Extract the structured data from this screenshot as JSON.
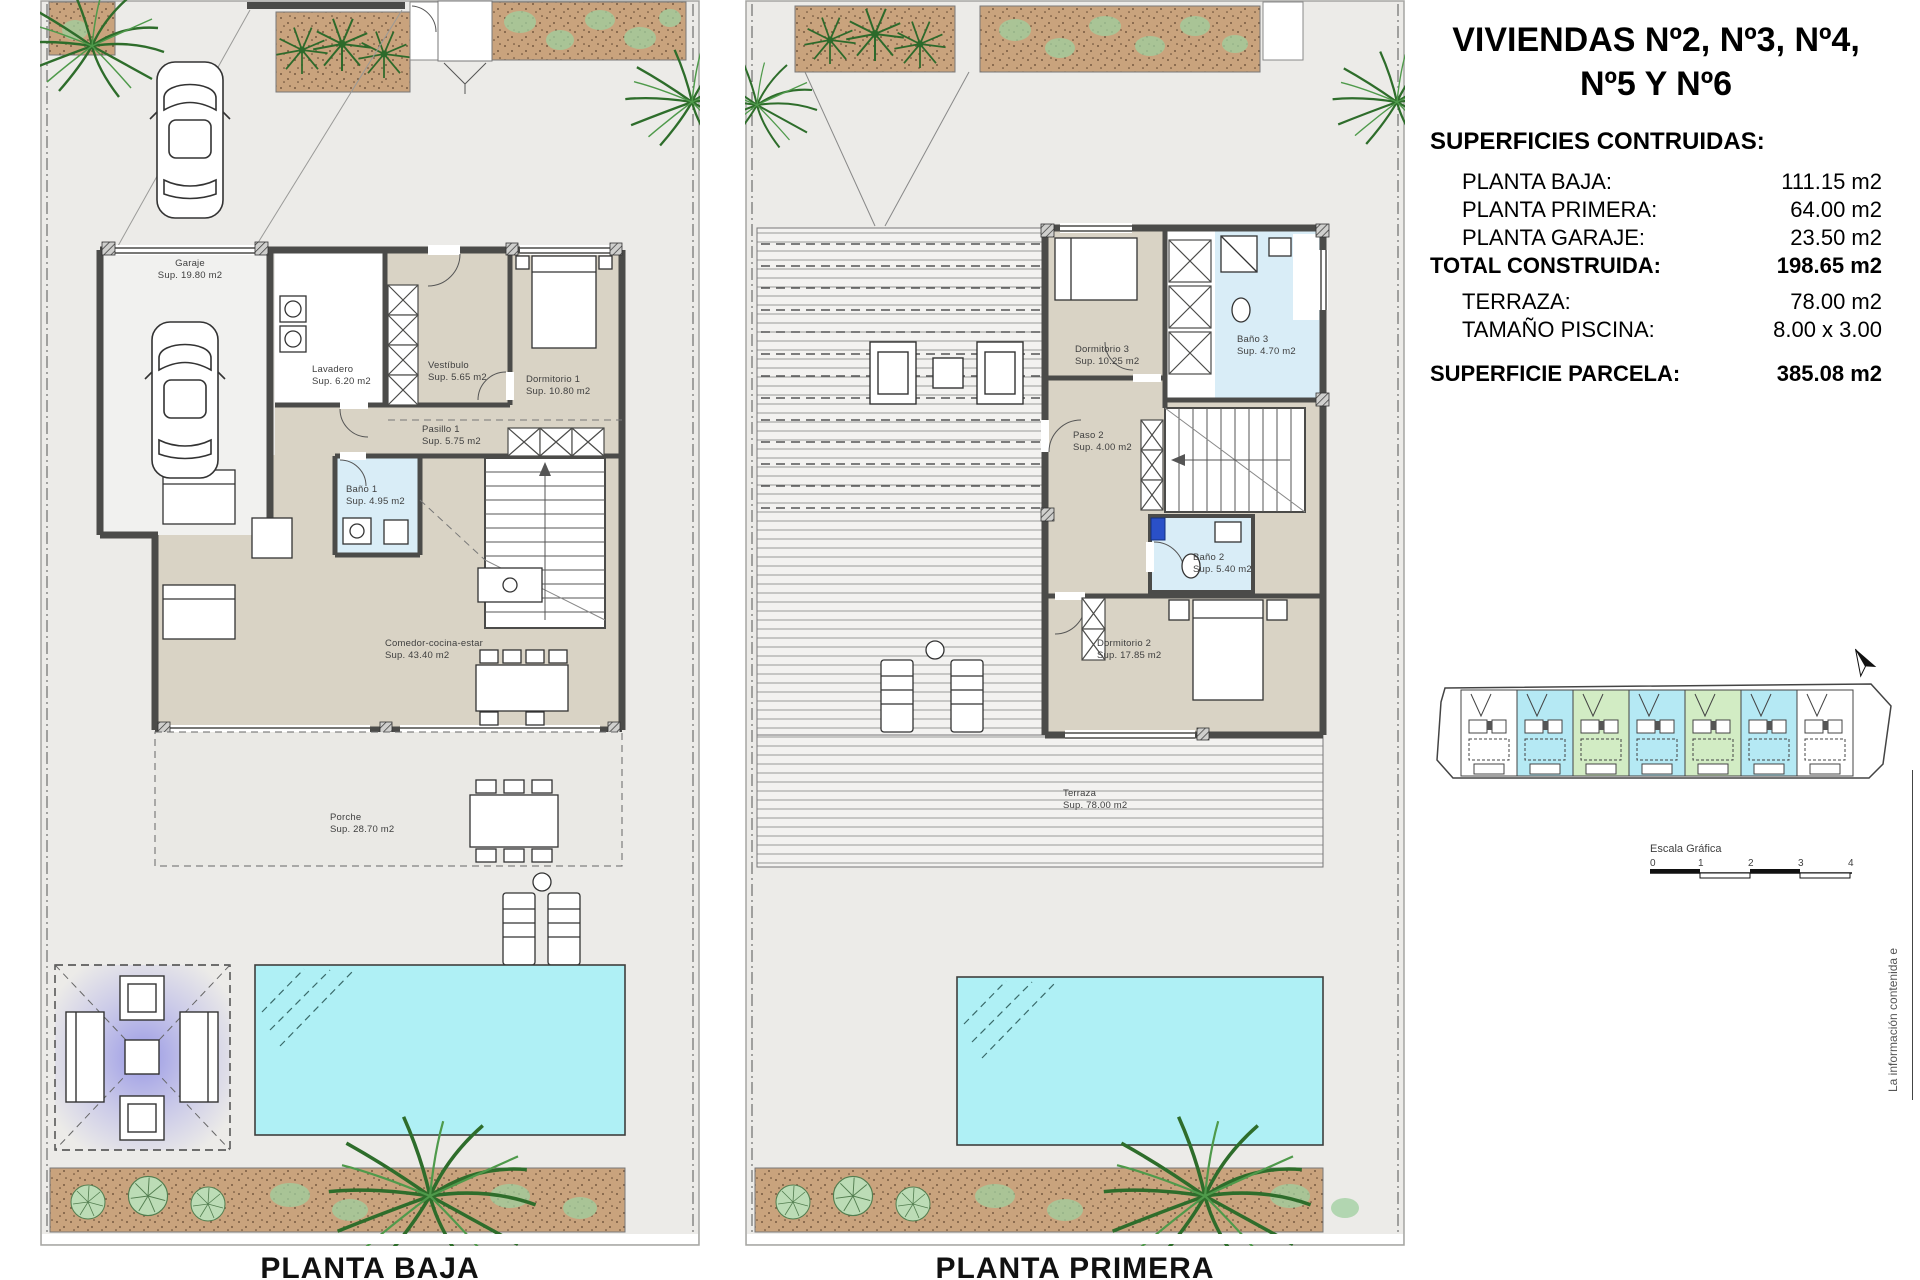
{
  "panel": {
    "title_line1": "VIVIENDAS Nº2, Nº3, Nº4,",
    "title_line2": "Nº5 Y Nº6",
    "superficies_heading": "SUPERFICIES CONTRUIDAS:",
    "rows": [
      {
        "label": "PLANTA BAJA:",
        "value": "111.15 m2"
      },
      {
        "label": "PLANTA PRIMERA:",
        "value": "64.00 m2"
      },
      {
        "label": "PLANTA GARAJE:",
        "value": "23.50 m2"
      },
      {
        "label": "TOTAL CONSTRUIDA:",
        "value": "198.65 m2"
      },
      {
        "label": "TERRAZA:",
        "value": "78.00 m2"
      },
      {
        "label": "TAMAÑO PISCINA:",
        "value": "8.00 x 3.00"
      },
      {
        "label": "SUPERFICIE PARCELA:",
        "value": "385.08 m2"
      }
    ],
    "scale_label": "Escala Gráfica",
    "scale_ticks": [
      "0",
      "1",
      "2",
      "3",
      "4"
    ],
    "side_note": "La información contenida e"
  },
  "plans": {
    "left": {
      "caption": "PLANTA BAJA",
      "rooms": [
        {
          "name": "Garaje",
          "area": "Sup. 19.80 m2"
        },
        {
          "name": "Lavadero",
          "area": "Sup. 6.20 m2"
        },
        {
          "name": "Vestíbulo",
          "area": "Sup. 5.65 m2"
        },
        {
          "name": "Dormitorio 1",
          "area": "Sup. 10.80 m2"
        },
        {
          "name": "Pasillo 1",
          "area": "Sup. 5.75 m2"
        },
        {
          "name": "Baño 1",
          "area": "Sup. 4.95 m2"
        },
        {
          "name": "Comedor-cocina-estar",
          "area": "Sup. 43.40 m2"
        },
        {
          "name": "Porche",
          "area": "Sup. 28.70 m2"
        }
      ]
    },
    "right": {
      "caption": "PLANTA PRIMERA",
      "rooms": [
        {
          "name": "Dormitorio 3",
          "area": "Sup. 10.25 m2"
        },
        {
          "name": "Baño 3",
          "area": "Sup. 4.70 m2"
        },
        {
          "name": "Paso 2",
          "area": "Sup. 4.00 m2"
        },
        {
          "name": "Baño 2",
          "area": "Sup. 5.40 m2"
        },
        {
          "name": "Dormitorio 2",
          "area": "Sup. 17.85 m2"
        },
        {
          "name": "Terraza",
          "area": "Sup. 78.00 m2"
        }
      ]
    }
  },
  "site_plan": {
    "units": [
      "white",
      "cyan",
      "green",
      "cyan",
      "green",
      "cyan",
      "white"
    ],
    "highlight_cyan": "#b5e9f4",
    "highlight_green": "#d2ecc4"
  },
  "colors": {
    "pool": "#aff0f5",
    "wall": "#4b4b49",
    "room_beige": "#d9d3c5",
    "bath_blue": "#d9edf7",
    "planter": "#c9a37d"
  }
}
